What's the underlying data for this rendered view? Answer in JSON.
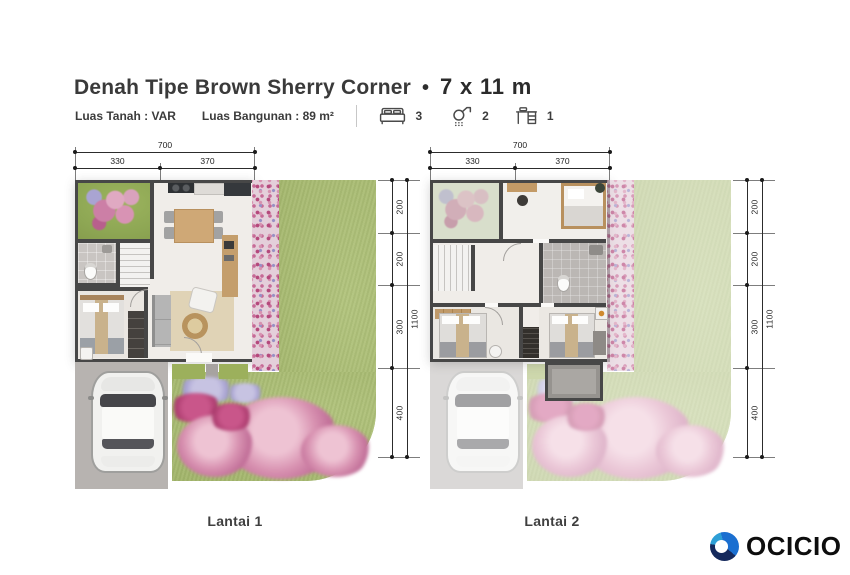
{
  "header": {
    "title": "Denah Tipe Brown Sherry Corner",
    "bullet": "•",
    "dimensions": "7 x 11 m",
    "land": "Luas Tanah : VAR",
    "building": "Luas Bangunan : 89 m²",
    "bedrooms": "3",
    "bathrooms": "2",
    "workspaces": "1",
    "icons": [
      "bed-icon",
      "shower-icon",
      "desk-icon"
    ]
  },
  "plans": [
    {
      "label": "Lantai 1",
      "dim_total_width": "700",
      "dim_width_left": "330",
      "dim_width_right": "370",
      "dim_heights": [
        "200",
        "200",
        "300",
        "400"
      ],
      "dim_total_height": "1100"
    },
    {
      "label": "Lantai 2",
      "dim_total_width": "700",
      "dim_width_left": "330",
      "dim_width_right": "370",
      "dim_heights": [
        "200",
        "200",
        "300",
        "400"
      ],
      "dim_total_height": "1100"
    }
  ],
  "footer": {
    "brand": "OCICIO"
  },
  "colors": {
    "wall": "#474747",
    "lawn": "#a9bd6e",
    "flower_pink": "#c0679a",
    "logo_navy": "#15295c",
    "logo_blue": "#1b6fd0"
  }
}
